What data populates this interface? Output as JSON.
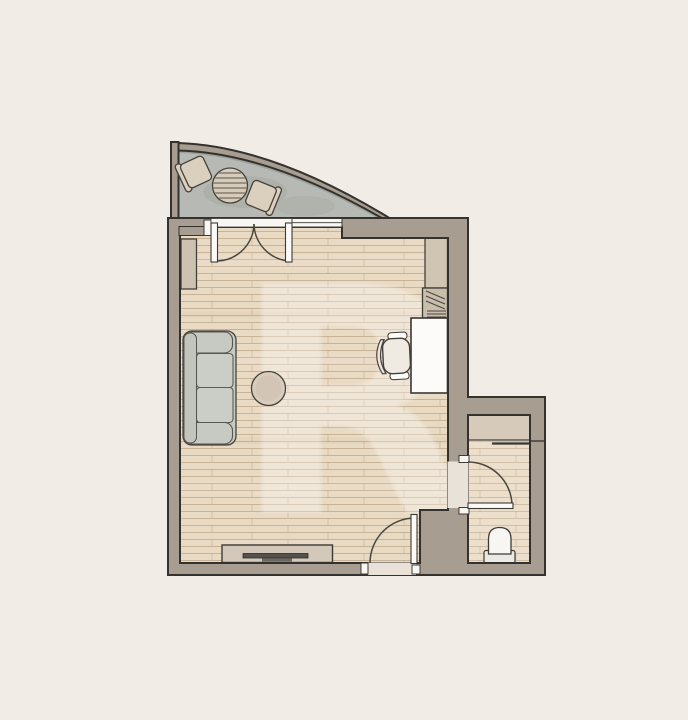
{
  "app": {
    "type": "architectural-floor-plan",
    "view": "top-down 2D apartment studio plan",
    "visible_text": []
  },
  "colors": {
    "background": "#f1ece5",
    "wall_fill": "#a89d91",
    "wall_outline": "#34322e",
    "wood_floor": "#e9dac4",
    "wood_line": "rgba(160,124,84,0.38)",
    "concrete": "#b7bab4",
    "threshold": "#e9e2d8",
    "fixture_white": "#f8f7f4",
    "door_leaf": "#fbfaf8",
    "sofa_fill": "#c7cac2",
    "sofa_back": "#c2c5bd",
    "cushion_fill": "#cbcec6",
    "beige_furniture": "#d7cbba",
    "coffee_table": "#d9ccbc",
    "desk_fill": "#fcfbf9",
    "chair_seat": "#f0ebe2",
    "chair_back": "#eee9e0",
    "sideboard_fill": "#d3c8b9",
    "tv_dark": "#55524c",
    "closet_fill": "#d6cabb",
    "toilet_white": "#f7f6f3",
    "toilet_tank": "#ebe9e4",
    "radiator_fill": "#cdc1b1",
    "wardrobe_fill": "#d0c4b2",
    "shelf_fill": "#c9bdac",
    "balcony_chair": "#dbcfbd",
    "watermark": "#ffffff"
  },
  "rooms": [
    {
      "name": "living-room",
      "floor": "wood-planks"
    },
    {
      "name": "bathroom",
      "floor": "wood-planks"
    },
    {
      "name": "balcony",
      "floor": "concrete",
      "shape": "quarter-curve"
    }
  ],
  "furniture": [
    "balcony-round-table",
    "balcony-chair-left",
    "balcony-chair-right",
    "sofa",
    "coffee-table",
    "radiator-shelf",
    "tv-sideboard",
    "tv",
    "desk",
    "office-chair",
    "wardrobe-column",
    "open-shelf",
    "bathroom-closet",
    "toilet"
  ],
  "openings": [
    "french-double-door-to-balcony",
    "window-top",
    "entry-door-bottom",
    "bathroom-door"
  ],
  "watermark_letter": "R"
}
